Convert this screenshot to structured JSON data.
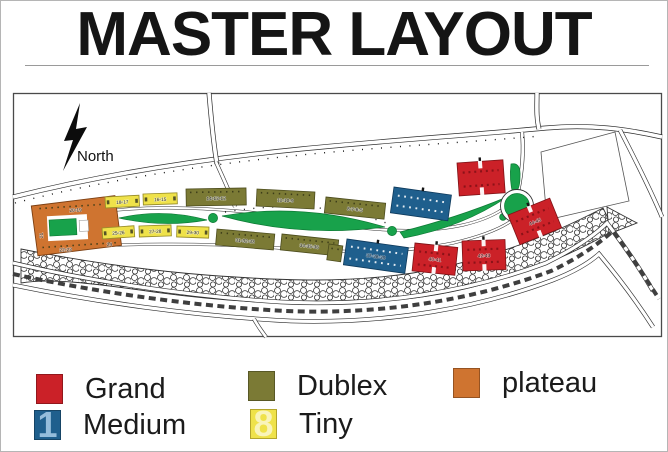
{
  "title": "MASTER LAYOUT",
  "map": {
    "north_label": "North",
    "building_labels": {
      "plateau_top": "20▫19",
      "plateau_left": "21",
      "plateau_bottom": "22▫23",
      "plateau_right": "24",
      "tiny_a": "18▫17",
      "tiny_b": "16▫15",
      "tiny_c": "25▫26",
      "tiny_d": "27▫28",
      "tiny_e": "29▫30",
      "dublex_a": "14▫13▫12",
      "dublex_b": "11▫10▫9",
      "dublex_c": "8▫7▫6▫5",
      "dublex_d": "31▫32▫33",
      "dublex_e": "34▫35▫36",
      "medium_a": "37▫38▫39",
      "grand_a": "40▫41",
      "grand_b": "42▫43",
      "grand_c": "44▫45"
    }
  },
  "legend": {
    "items": [
      {
        "id": "grand",
        "label": "Grand"
      },
      {
        "id": "medium",
        "label": "Medium"
      },
      {
        "id": "dublex",
        "label": "Dublex"
      },
      {
        "id": "tiny",
        "label": "Tiny"
      },
      {
        "id": "plateau",
        "label": "plateau"
      }
    ]
  },
  "watermark": {
    "medium_digit": "1",
    "tiny_digit": "8"
  },
  "colors": {
    "grand": "#cb2128",
    "medium": "#1f5f8d",
    "dublex": "#7b7a35",
    "tiny": "#efe24a",
    "plateau": "#cf7430",
    "park": "#18a24b"
  }
}
